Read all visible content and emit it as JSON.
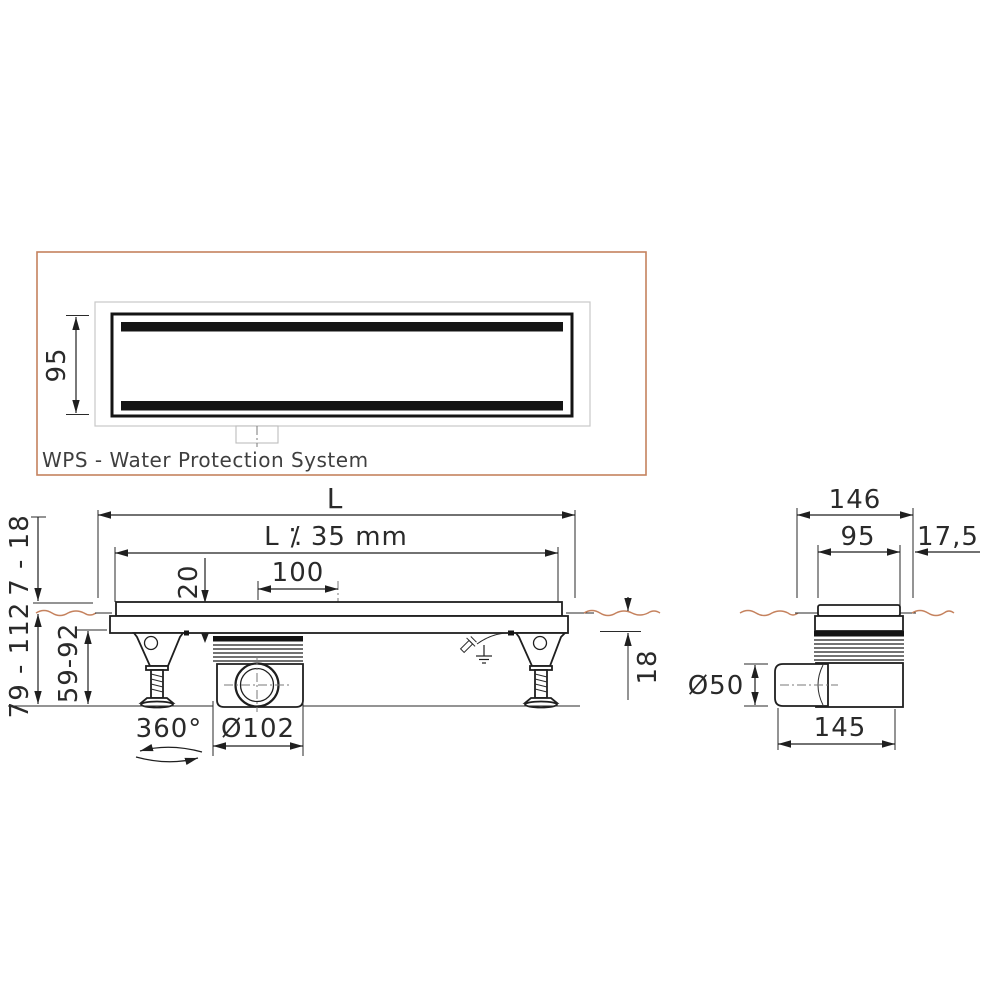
{
  "colors": {
    "accent_orange": "#c5825e",
    "line": "#1f1f1f",
    "frame_gray": "#c8c8c8",
    "caption_gray": "#3f3f3f"
  },
  "top_view": {
    "grate_width": "95",
    "caption": "WPS - Water Protection System"
  },
  "side_view": {
    "total_length": "L",
    "grate_length": "L ⁒ 35 mm",
    "outlet_offset": "100",
    "grate_depth": "20",
    "tile_thickness_range": "7 - 18",
    "install_height_range": "79 - 112",
    "body_height_range": "59-92",
    "foot_rotation": "360°",
    "trap_diameter": "Ø102",
    "under_tile_depth": "18"
  },
  "end_view": {
    "flange_width": "146",
    "grate_width": "95",
    "edge_offset": "17,5",
    "outlet_diameter": "Ø50",
    "body_width": "145"
  }
}
